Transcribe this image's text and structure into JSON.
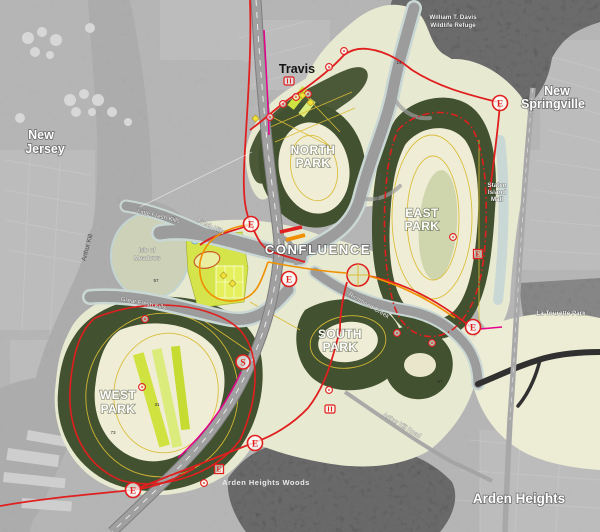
{
  "park_labels": {
    "north_park": {
      "line1": "NORTH",
      "line2": "PARK"
    },
    "east_park": {
      "line1": "EAST",
      "line2": "PARK"
    },
    "south_park": {
      "line1": "SOUTH",
      "line2": "PARK"
    },
    "west_park": {
      "line1": "WEST",
      "line2": "PARK"
    },
    "confluence": "CONFLUENCE"
  },
  "region_labels": {
    "new_jersey": {
      "line1": "New",
      "line2": "Jersey"
    },
    "travis": "Travis",
    "new_springville": {
      "line1": "New",
      "line2": "Springville"
    },
    "wildlife_refuge": {
      "line1": "William T. Davis",
      "line2": "Wildlife Refuge"
    },
    "staten_island_mall": {
      "line1": "Staten",
      "line2": "Island",
      "line3": "Mall"
    },
    "la_tourette_park": "La Tourette Park",
    "arden_heights": "Arden Heights",
    "arden_heights_woods": "Arden Heights Woods"
  },
  "water_labels": {
    "arthur_kill": "Arthur Kill",
    "little_fresh_kills": "Little Fresh Kills",
    "fresh_kills": "Fresh Kills",
    "great_fresh_kills": "Great Fresh Kills",
    "main_creek": "Main Creek",
    "richmond_creek": "Richmond Creek",
    "isle_of_meadows": {
      "line1": "Isle of",
      "line2": "Meadows"
    }
  },
  "road_labels": {
    "arthur_kill_road": "Arthur Kill Road"
  },
  "markers": {
    "entrance_letter": "E",
    "transit_letter": "S"
  },
  "area_numbers": [
    "14",
    "57",
    "31",
    "73",
    "67"
  ],
  "colors": {
    "road_red": "#e01f1f",
    "road_orange": "#f09000",
    "rail_magenta": "#e7008b",
    "trail_yellow": "#d9bc35",
    "field_chartreuse": "#cfe23f",
    "mound_cream": "#f0edd6",
    "park_dark_green": "#42512f",
    "wetland_sage": "#e6e7cf",
    "water_gray": "#999999",
    "city_gray": "#a9a9a9",
    "woods_black": "#151515",
    "label_white": "#ffffff"
  }
}
